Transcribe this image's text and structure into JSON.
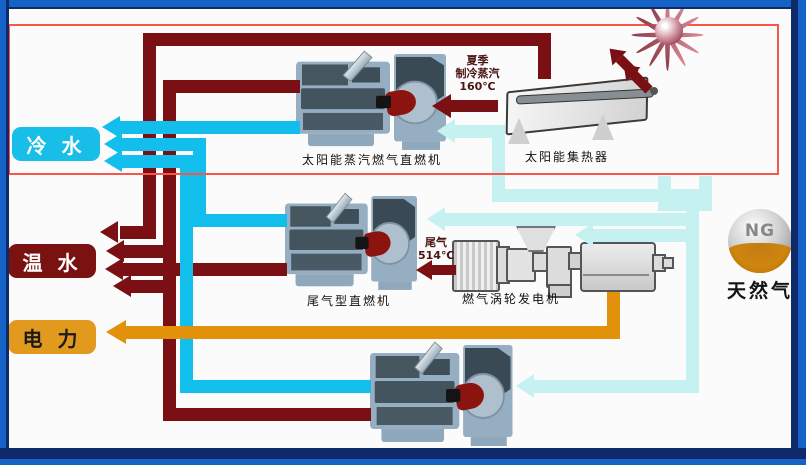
{
  "diagram": {
    "outputs": [
      {
        "label": "冷 水",
        "name": "cold-water",
        "fill": "#18bee8",
        "text_color": "#ffffff"
      },
      {
        "label": "温 水",
        "name": "warm-water",
        "fill": "#7a1212",
        "text_color": "#ffffff"
      },
      {
        "label": "电 力",
        "name": "electric-power",
        "fill": "#e29a1e",
        "text_color": "#1b1b1b"
      }
    ],
    "equipment": {
      "solar_chiller_label": "太阳能蒸汽燃气直燃机",
      "solar_collector_label": "太阳能集热器",
      "exhaust_chiller_label": "尾气型直燃机",
      "gas_turbine_label": "燃气涡轮发电机",
      "gas_chiller_label": "燃气型直燃机",
      "ng_sphere_text": "NG",
      "natural_gas_label": "天然气"
    },
    "annotations": {
      "solar_steam_line1": "夏季",
      "solar_steam_line2": "制冷蒸汽",
      "solar_steam_line3": "160℃",
      "exhaust_line1": "尾气",
      "exhaust_line2": "514℃"
    },
    "flow_colors": {
      "cold_water": "#12beec",
      "hot_water_steam": "#7a0f14",
      "electricity": "#e2920a",
      "natural_gas": "#c6f1f1"
    },
    "frame_colors": {
      "outer_blue": "#1563c6",
      "inner_navy": "#0e2a6b",
      "highlight_box": "#fa554a"
    }
  }
}
